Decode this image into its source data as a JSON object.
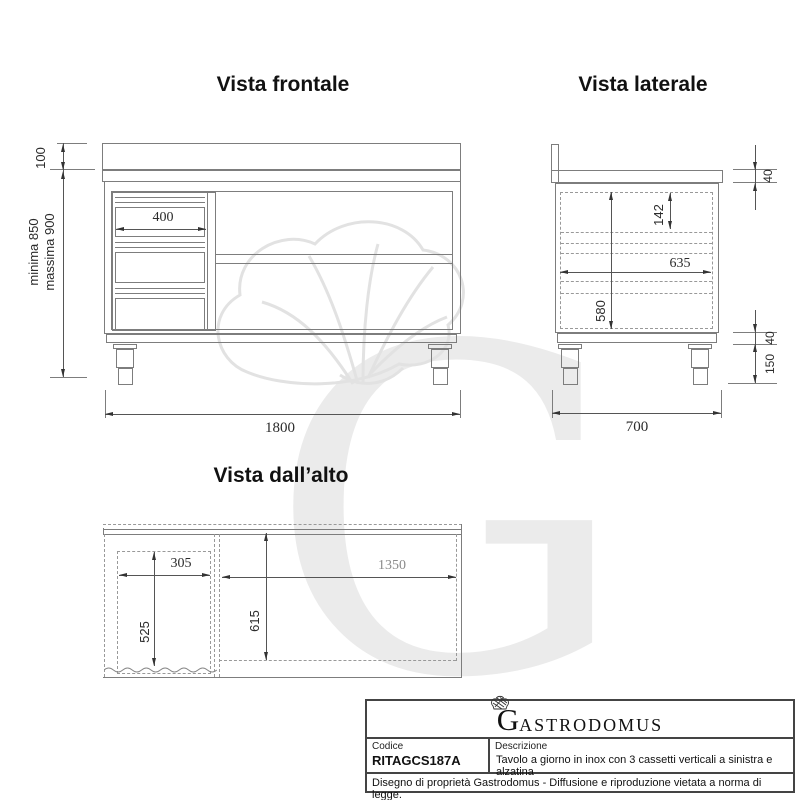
{
  "views": {
    "front": {
      "title": "Vista frontale",
      "dims": {
        "top_height": "100",
        "min_height": "minima 850",
        "max_height": "massima 900",
        "drawer_width": "400",
        "total_width": "1800"
      }
    },
    "side": {
      "title": "Vista laterale",
      "dims": {
        "worktop_thickness": "40",
        "drawer_front_height": "142",
        "inner_depth": "635",
        "drawer_unit_height": "580",
        "plinth_height": "40",
        "leg_height": "150",
        "total_depth": "700"
      }
    },
    "top": {
      "title": "Vista dall’alto",
      "dims": {
        "drawer_block_width": "305",
        "open_compartment_width": "1350",
        "drawer_block_depth": "525",
        "inner_depth": "615"
      }
    }
  },
  "title_block": {
    "logo_initial": "G",
    "logo_rest": "ASTRODOMUS",
    "code_label": "Codice",
    "code_value": "RITAGCS187A",
    "description_label": "Descrizione",
    "description_value": "Tavolo a giorno in inox con 3 cassetti verticali a sinistra e alzatina",
    "legal_notice": "Disegno di proprietà Gastrodomus - Diffusione e riproduzione vietata a norma di legge."
  },
  "watermark": {
    "letter": "G"
  },
  "colors": {
    "line": "#7d7d7d",
    "dim_line": "#555555",
    "text": "#2b2b2b",
    "watermark": "#ebebeb"
  }
}
